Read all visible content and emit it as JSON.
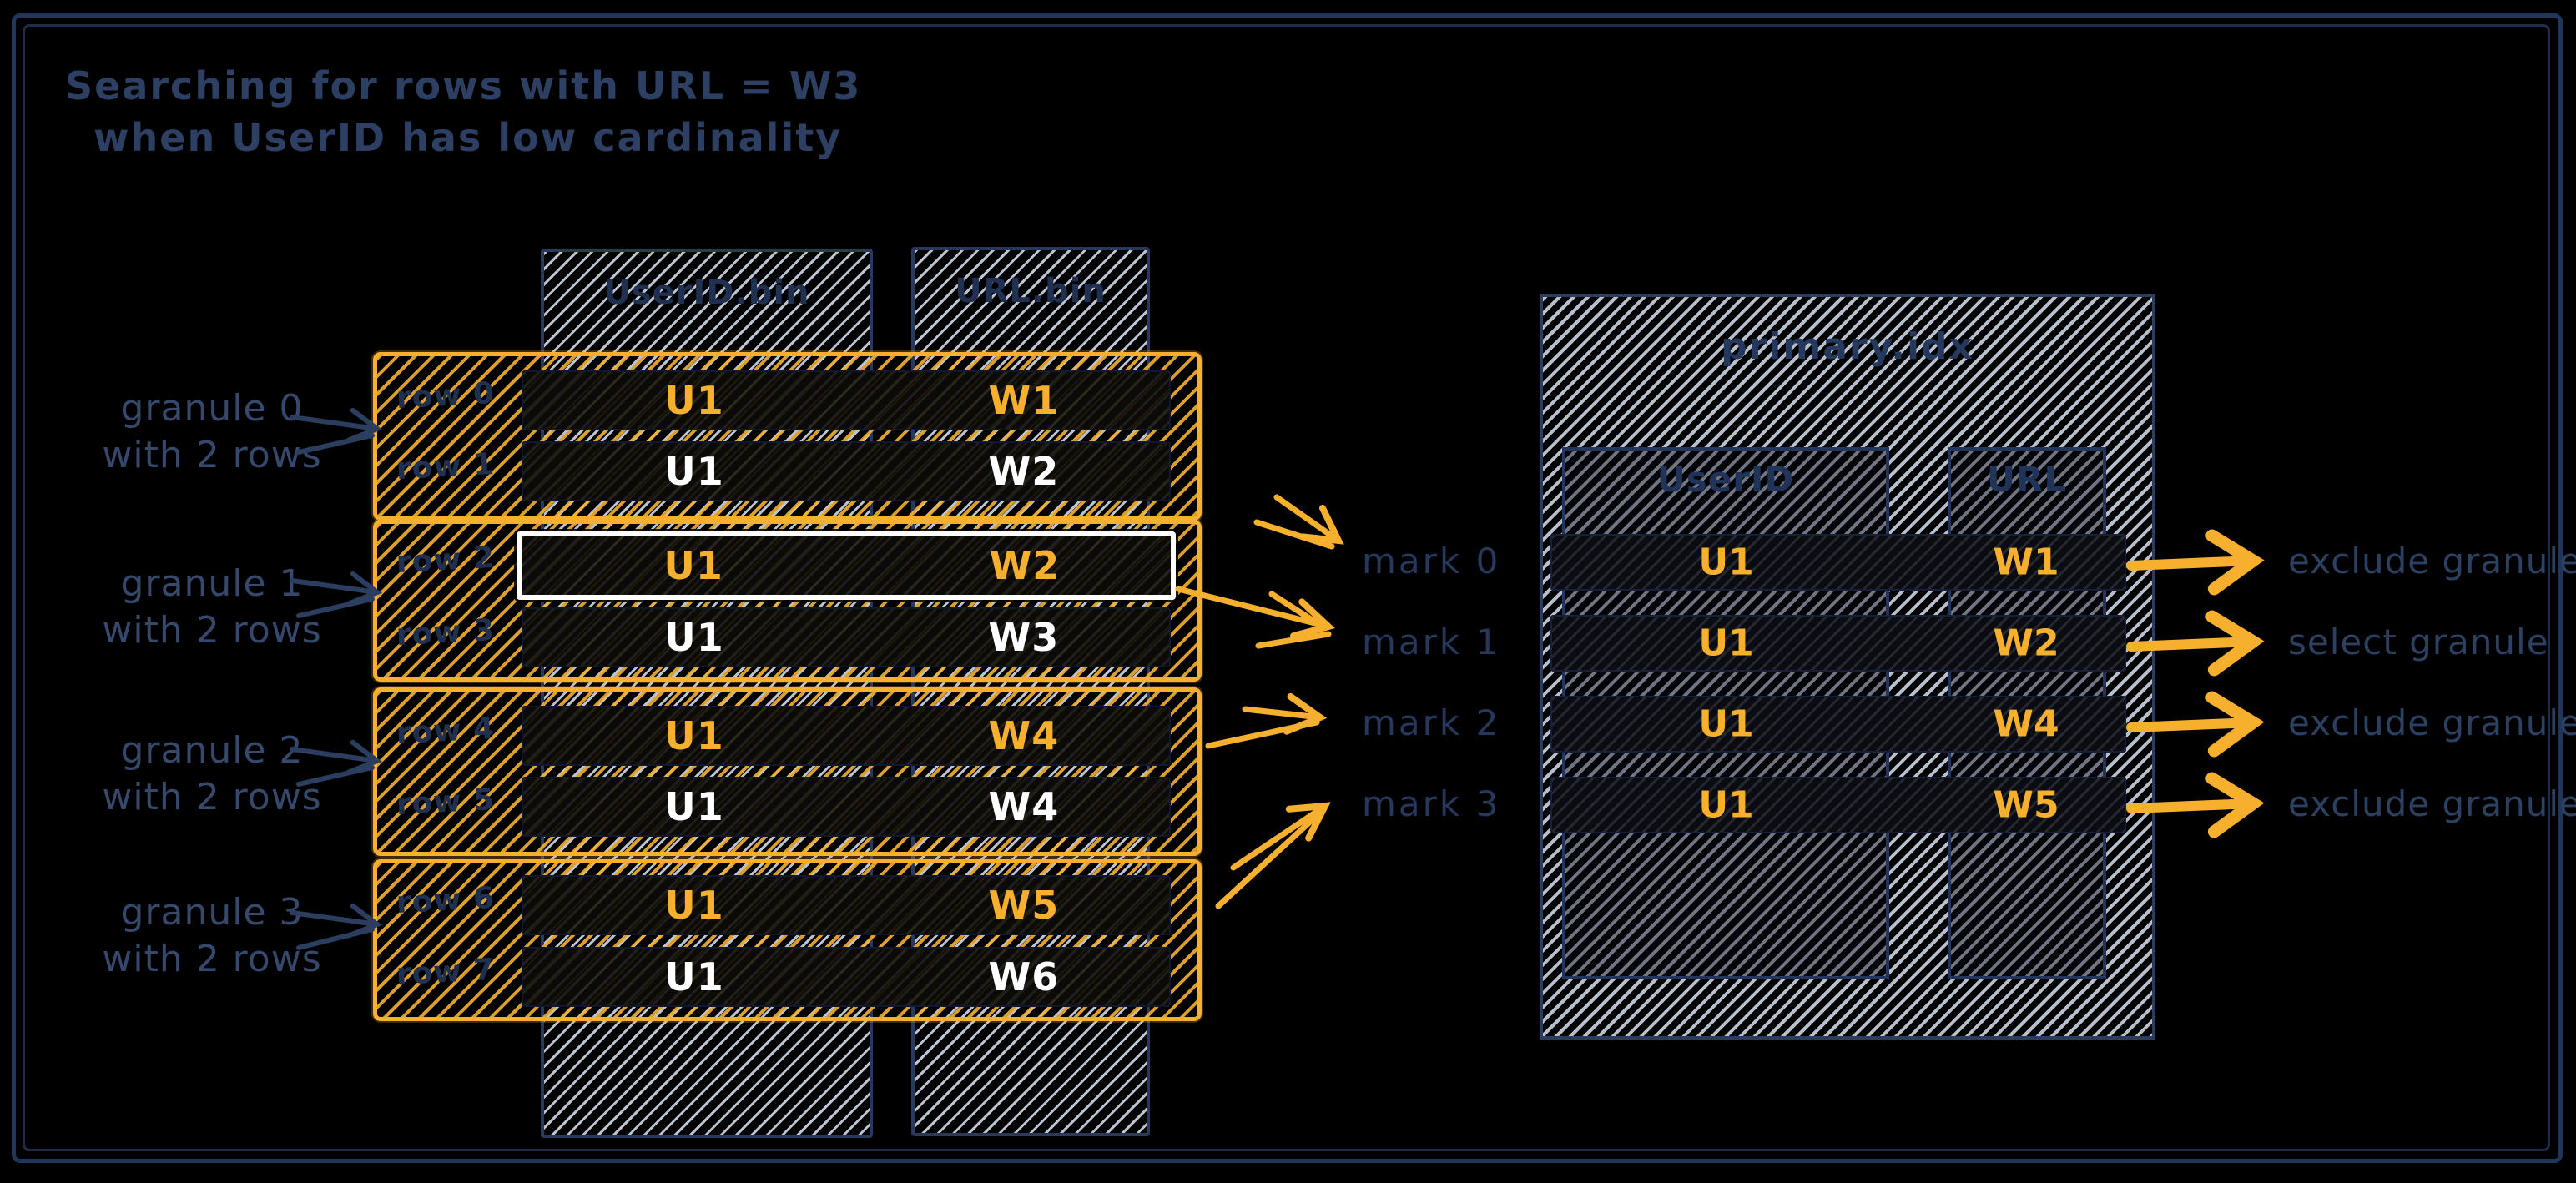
{
  "title": {
    "line1": "Searching for rows with URL = W3",
    "line2": "when UserID has low cardinality"
  },
  "left_table": {
    "columns": [
      {
        "label": "UserID.bin"
      },
      {
        "label": "URL.bin"
      }
    ],
    "granules": [
      {
        "name": "granule 0",
        "note": "with 2 rows",
        "rows": [
          {
            "label": "row 0",
            "user_id": "U1",
            "url": "W1"
          },
          {
            "label": "row 1",
            "user_id": "U1",
            "url": "W2"
          }
        ]
      },
      {
        "name": "granule 1",
        "note": "with 2 rows",
        "rows": [
          {
            "label": "row 2",
            "user_id": "U1",
            "url": "W2"
          },
          {
            "label": "row 3",
            "user_id": "U1",
            "url": "W3"
          }
        ]
      },
      {
        "name": "granule 2",
        "note": "with 2 rows",
        "rows": [
          {
            "label": "row 4",
            "user_id": "U1",
            "url": "W4"
          },
          {
            "label": "row 5",
            "user_id": "U1",
            "url": "W4"
          }
        ]
      },
      {
        "name": "granule 3",
        "note": "with 2 rows",
        "rows": [
          {
            "label": "row 6",
            "user_id": "U1",
            "url": "W5"
          },
          {
            "label": "row 7",
            "user_id": "U1",
            "url": "W6"
          }
        ]
      }
    ]
  },
  "marks": [
    {
      "label": "mark 0"
    },
    {
      "label": "mark 1"
    },
    {
      "label": "mark 2"
    },
    {
      "label": "mark 3"
    }
  ],
  "index_table": {
    "title": "primary.idx",
    "columns": [
      {
        "label": "UserID"
      },
      {
        "label": "URL"
      }
    ],
    "rows": [
      {
        "user_id": "U1",
        "url": "W1",
        "action": "exclude granule"
      },
      {
        "user_id": "U1",
        "url": "W2",
        "action": "select granule"
      },
      {
        "user_id": "U1",
        "url": "W4",
        "action": "exclude granule"
      },
      {
        "user_id": "U1",
        "url": "W5",
        "action": "exclude granule"
      }
    ]
  },
  "colors": {
    "background": "#000000",
    "navy": "#2d4063",
    "orange": "#f6b02e",
    "hatch_gray": "#cbd4e2",
    "white": "#ffffff"
  }
}
